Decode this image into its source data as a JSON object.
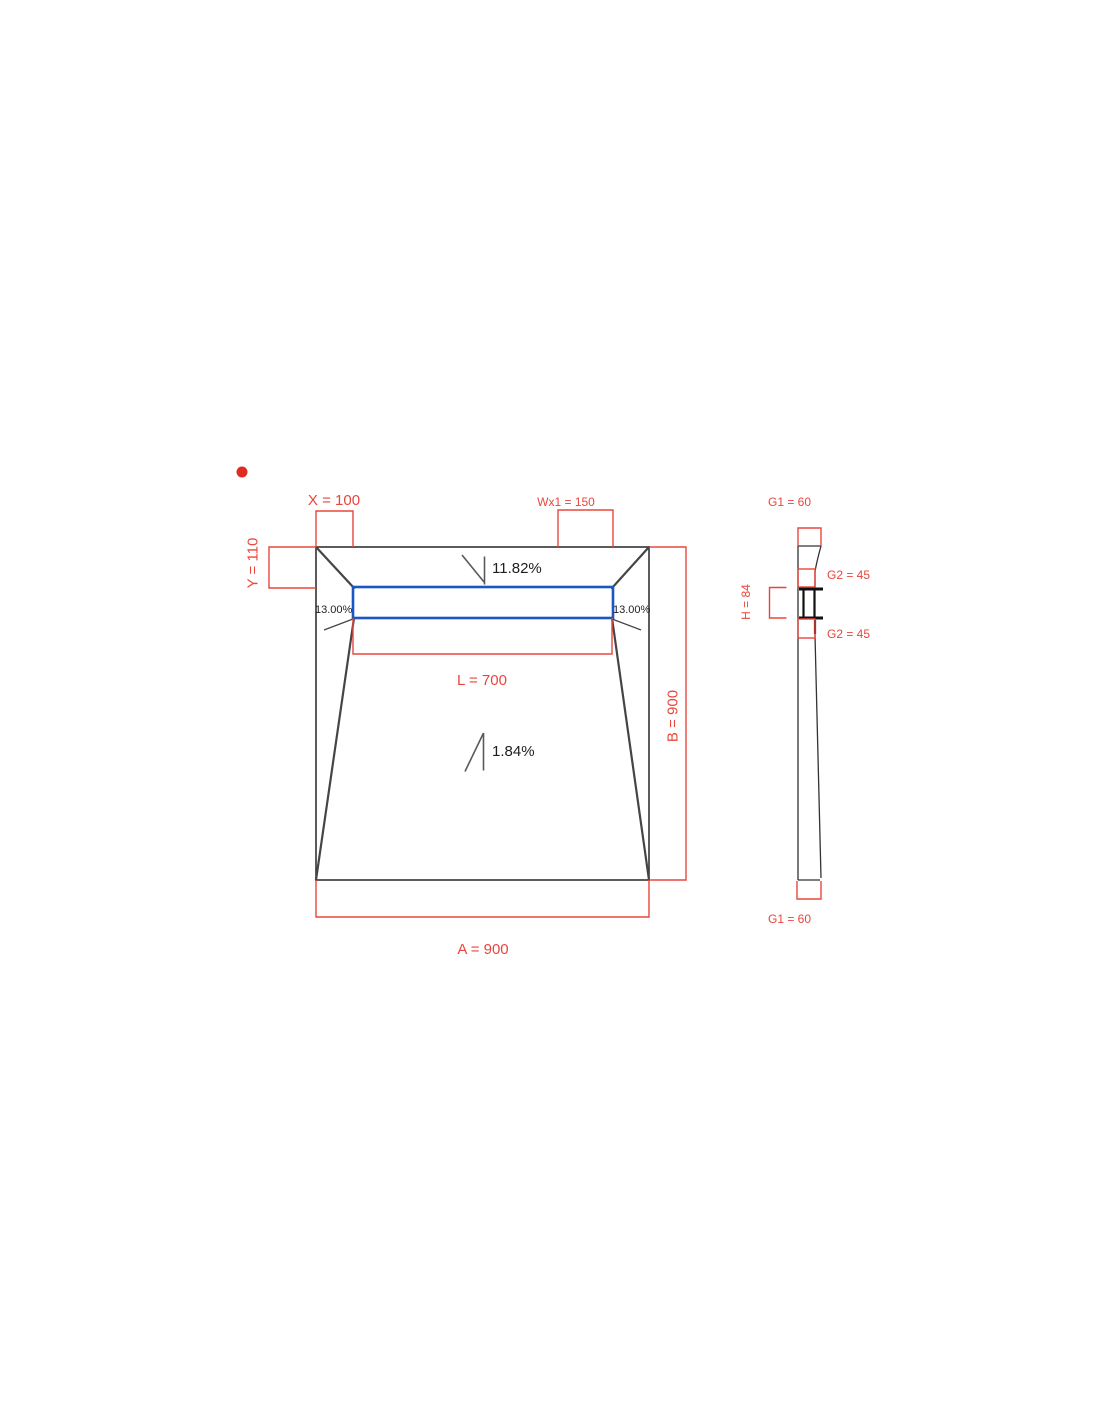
{
  "plan": {
    "x_label": "X = 100",
    "y_label": "Y = 110",
    "wx1_label": "Wx1 = 150",
    "l_label": "L = 700",
    "a_label": "A = 900",
    "b_label": "B = 900",
    "slope_top": "11.82%",
    "slope_bottom": "1.84%",
    "slope_left": "13.00%",
    "slope_right": "13.00%"
  },
  "section": {
    "g1_top": "G1 = 60",
    "g2_upper": "G2 = 45",
    "g2_lower": "G2 = 45",
    "g1_bottom": "G1 = 60",
    "h_label": "H = 84"
  },
  "colors": {
    "dimension_red": "#e8463c",
    "marker_red": "#e02b20",
    "channel_blue": "#1a56c4",
    "outline_dark": "#333333",
    "annotation_gray": "#5a5a5a",
    "text_black": "#1e1e1e"
  }
}
